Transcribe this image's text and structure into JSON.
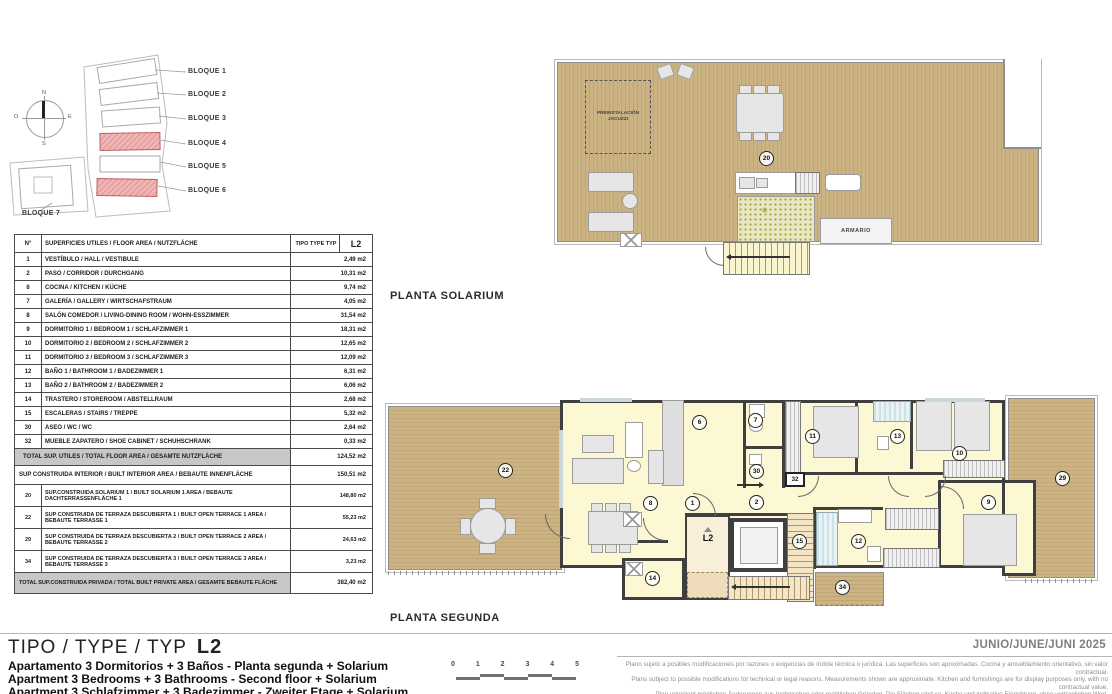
{
  "site_plan": {
    "compass": {
      "n": "N",
      "e": "E",
      "s": "S",
      "o": "O"
    },
    "blocks": [
      "BLOQUE 1",
      "BLOQUE 2",
      "BLOQUE 3",
      "BLOQUE 4",
      "BLOQUE 5",
      "BLOQUE 6",
      "BLOQUE 7"
    ]
  },
  "area_table": {
    "header": {
      "num": "N°",
      "desc": "SUPERFICIES UTILES / FLOOR AREA / NUTZFLÄCHE",
      "tipo": "TIPO TYPE TYP",
      "type_code": "L2"
    },
    "rows": [
      {
        "n": "1",
        "d": "VESTÍBULO / HALL / VESTIBULE",
        "v": "2,49 m2"
      },
      {
        "n": "2",
        "d": "PASO  / CORRIDOR / DURCHGANG",
        "v": "10,31 m2"
      },
      {
        "n": "6",
        "d": "COCINA  / KITCHEN / KÜCHE",
        "v": "9,74 m2"
      },
      {
        "n": "7",
        "d": "GALERÍA / GALLERY / WIRTSCHAFSTRAUM",
        "v": "4,05 m2"
      },
      {
        "n": "8",
        "d": "SALÓN COMEDOR / LIVING-DINING ROOM / WOHN-ESSZIMMER",
        "v": "31,54 m2"
      },
      {
        "n": "9",
        "d": "DORMITORIO 1 / BEDROOM 1 / SCHLAFZIMMER 1",
        "v": "18,31 m2"
      },
      {
        "n": "10",
        "d": "DORMITORIO 2 / BEDROOM 2 / SCHLAFZIMMER 2",
        "v": "12,65 m2"
      },
      {
        "n": "11",
        "d": "DORMITORIO 3 / BEDROOM 3 / SCHLAFZIMMER 3",
        "v": "12,09 m2"
      },
      {
        "n": "12",
        "d": "BAÑO 1 / BATHROOM 1 / BADEZIMMER 1",
        "v": "6,31 m2"
      },
      {
        "n": "13",
        "d": "BAÑO 2 / BATHROOM 2  / BADEZIMMER 2",
        "v": "6,06 m2"
      },
      {
        "n": "14",
        "d": "TRASTERO / STOREROOM / ABSTELLRAUM",
        "v": "2,68 m2"
      },
      {
        "n": "15",
        "d": "ESCALERAS / STAIRS / TREPPE",
        "v": "5,32 m2"
      },
      {
        "n": "30",
        "d": "ASEO / WC / WC",
        "v": "2,64 m2"
      },
      {
        "n": "32",
        "d": "MUEBLE ZAPATERO / SHOE CABINET / SCHUHSCHRANK",
        "v": "0,33 m2"
      }
    ],
    "total_utiles": {
      "d": "TOTAL SUP. UTILES / TOTAL FLOOR AREA / GESAMTE NUTZFLÄCHE",
      "v": "124,52 m2"
    },
    "built_interior": {
      "d": "SUP CONSTRUIDA INTERIOR / BUILT INTERIOR AREA / BEBAUTE INNENFLÄCHE",
      "v": "150,51 m2"
    },
    "extra_rows": [
      {
        "n": "20",
        "d": "SUP.CONSTRUIDA SOLARIUM 1 / BUILT SOLARIUM 1 AREA / BEBAUTE DACHTERRASSENFLÄCHE 1",
        "v": "148,80 m2"
      },
      {
        "n": "22",
        "d": "SUP CONSTRUIDA DE TERRAZA DESCUBIERTA 1 / BUILT OPEN TERRACE 1 AREA / BEBAUTE TERRASSE 1",
        "v": "55,23 m2"
      },
      {
        "n": "29",
        "d": "SUP CONSTRUIDA DE TERRAZA DESCUBIERTA 2 / BUILT OPEN TERRACE 2 AREA / BEBAUTE TERRASSE 2",
        "v": "24,63 m2"
      },
      {
        "n": "34",
        "d": "SUP CONSTRUIDA DE TERRAZA DESCUBIERTA 3 / BUILT OPEN TERRACE 3 AREA / BEBAUTE TERRASSE 3",
        "v": "3,23 m2"
      }
    ],
    "total_private": {
      "d": "TOTAL SUP.CONSTRUIDA PRIVADA / TOTAL  BUILT PRIVATE AREA / GESAMTE BEBAUTE FLÄCHE",
      "v": "382,40 m2"
    }
  },
  "solarium": {
    "label": "PLANTA SOLARIUM",
    "room_number": "20",
    "jacuzzi_label": "PREINSTALACIÓN JACUZZI",
    "armario_label": "ARMARIO"
  },
  "second_floor": {
    "label": "PLANTA SEGUNDA",
    "unit_code": "L2",
    "rooms": {
      "terrace1": "22",
      "living": "8",
      "hall": "1",
      "kitchen": "6",
      "gallery": "7",
      "wc": "30",
      "shoe_cabinet": "32",
      "corridor": "2",
      "bed3": "11",
      "bath2": "13",
      "bed2": "10",
      "terrace2": "29",
      "bed1": "9",
      "bath1": "12",
      "stairs": "15",
      "storeroom": "14",
      "terrace3": "34"
    }
  },
  "footer": {
    "title": "TIPO / TYPE / TYP",
    "code": "L2",
    "desc_es": "Apartamento 3 Dormitorios + 3 Baños - Planta segunda + Solarium",
    "desc_en": "Apartment 3 Bedrooms + 3 Bathrooms - Second floor + Solarium",
    "desc_de": "Apartment 3 Schlafzimmer + 3 Badezimmer - Zweiter Etage + Solarium",
    "date": "JUNIO/JUNE/JUNI 2025",
    "scale_ticks": [
      "0",
      "1",
      "2",
      "3",
      "4",
      "5"
    ],
    "disclaimer_es": "Plano sujeto a posibles modificaciones por razones o exigencias de índole técnica o jurídica. Las superficies son aproximadas. Cocina y amueblamiento orientativo, sin valor contractual.",
    "disclaimer_en": "Plans subject to possible modifications for technical or legal reasons. Measurements shown are approximate. Kitchen and furnishings are for display purposes only, with no contractual value.",
    "disclaimer_de": "Plan unterliegt möglichen Änderungen aus technischen oder rechtlichen Gründen. Die Flächen sind ca. Küche und indikative Einrichtung, ohne vertraglichen Wert."
  },
  "colors": {
    "wood_deck": "#ccb384",
    "room_fill": "#fcf8d4",
    "wall": "#3f3f3f",
    "highlight_block": "#f0b5b5",
    "date_text": "#7e7e7e"
  }
}
